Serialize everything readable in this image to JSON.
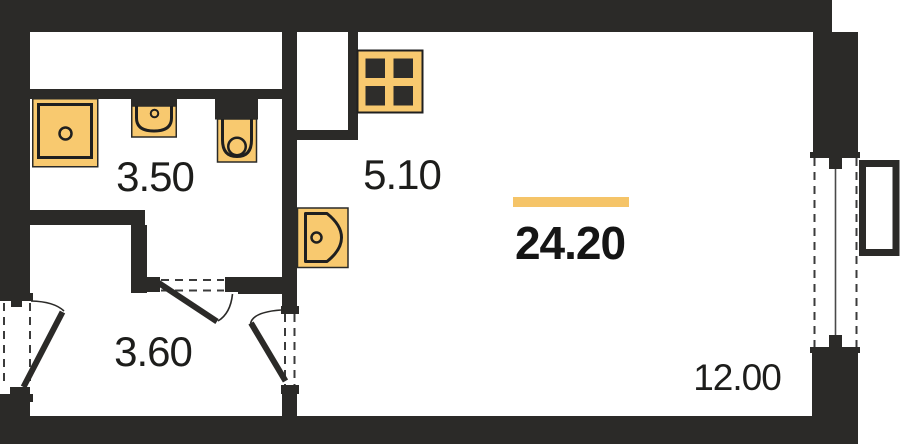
{
  "floor_plan": {
    "total_area_label": "24.20",
    "rooms": [
      {
        "name": "bathroom",
        "area_label": "3.50"
      },
      {
        "name": "kitchen",
        "area_label": "5.10"
      },
      {
        "name": "hallway",
        "area_label": "3.60"
      },
      {
        "name": "living-area",
        "area_label": "12.00"
      }
    ],
    "fixtures": [
      "shower",
      "washbasin",
      "toilet",
      "stove",
      "kitchen-sink"
    ],
    "doors": [
      "entrance-door",
      "bathroom-door",
      "living-room-door"
    ],
    "window": "balcony-window",
    "balcony": "balcony",
    "colors": {
      "wall": "#2B2A28",
      "fixture_fill": "#F8C96F",
      "accent_bar": "#F5C468",
      "label_text": "#1D1D1B",
      "background": "#FFFFFF"
    }
  }
}
